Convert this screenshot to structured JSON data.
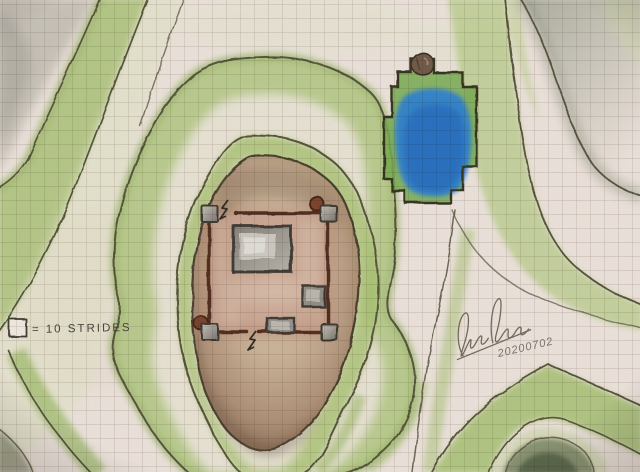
{
  "map": {
    "medium": "hand-drawn colored-pencil map on graph paper",
    "legend": {
      "swatch": "one-grid-square",
      "label": "= 10 STRIDES"
    },
    "signature": {
      "scribble": "illegible cursive signature",
      "date": "20200702"
    },
    "palette": {
      "paper": "#ece5dc",
      "grid_line": "#8d7b72",
      "contour_green": "#9cbb63",
      "contour_outline": "#55523a",
      "hill_brown": "#b3957a",
      "wall_dark_brown": "#4d2a1b",
      "tower_gray": "#94908a",
      "turret_red_brown": "#7a3f2a",
      "pond_blue": "#2b7fd2",
      "pond_bank_green": "#74a94e",
      "boulder_brown": "#6e5947",
      "northeast_gray": "#8e9483"
    },
    "features": [
      {
        "id": "walled-keep",
        "label": "square curtain wall with four corner towers, two round turrets, a keep and two outbuildings, gate marks north-west and south"
      },
      {
        "id": "central-hill",
        "label": "brown oval hill ringed by two green contour bands"
      },
      {
        "id": "pond",
        "label": "blue pond with green banks and a boulder at its north tip"
      },
      {
        "id": "northwest-slope",
        "label": "nested green contour bands with gray crest, top-left"
      },
      {
        "id": "east-ridge",
        "label": "green ridge band sweeping from north to south-east past the pond"
      },
      {
        "id": "southeast-knoll",
        "label": "green knoll with dark gray-green crest, bottom-right"
      }
    ]
  }
}
